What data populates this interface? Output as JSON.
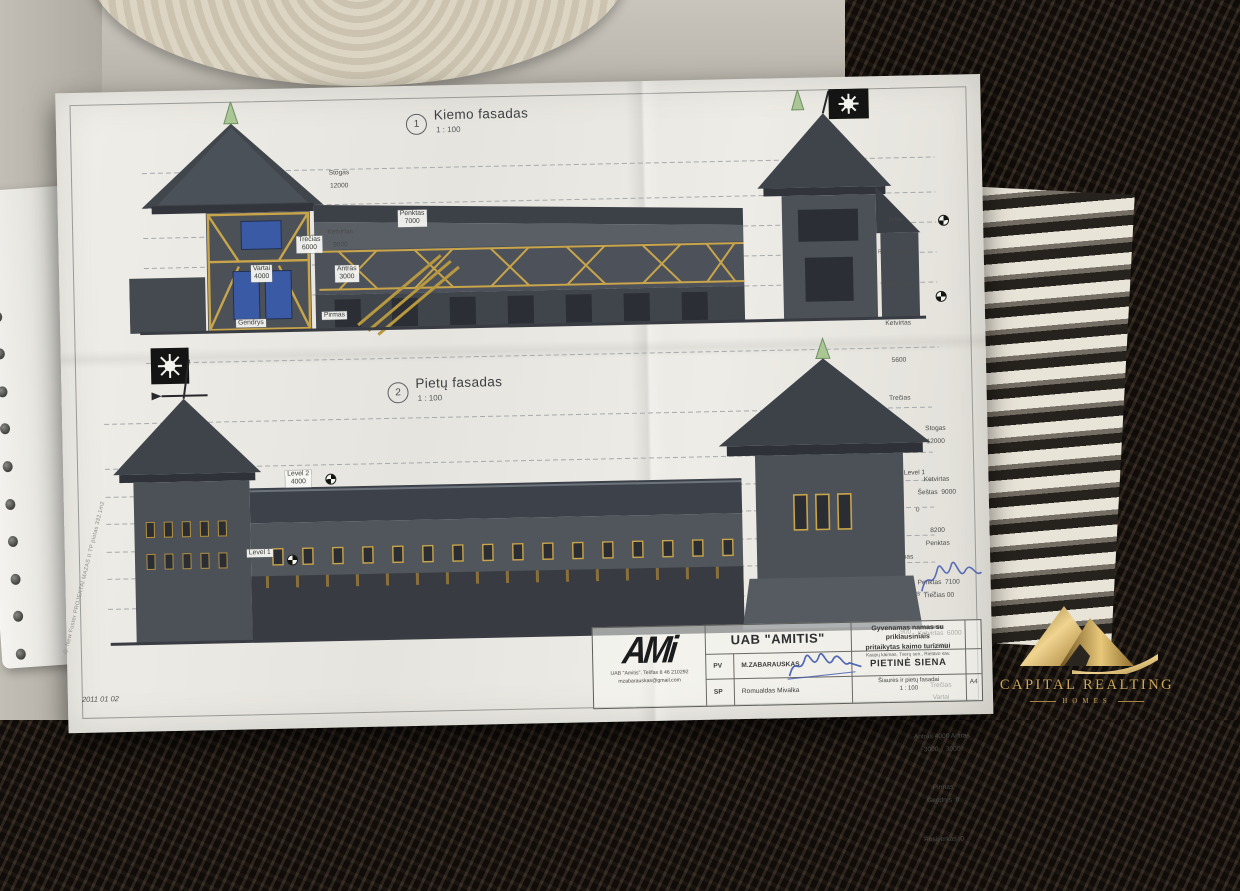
{
  "photo": {
    "date_note": "2011 01 02",
    "margin_note": "G: New Fuster PROJEKTAI MAZAS II TP plotas 332.1m2"
  },
  "drawing1": {
    "number": "1",
    "title": "Kiemo fasadas",
    "scale": "1 : 100",
    "stack_left": [
      "Stogas",
      "12000",
      "Ketvirtas",
      "9000"
    ],
    "label_penktas": {
      "name": "Penktas",
      "value": "7000"
    },
    "label_trecias": {
      "name": "Trečias",
      "value": "6000"
    },
    "label_antras": {
      "name": "Antras",
      "value": "3000"
    },
    "label_vartai": {
      "name": "Vartai",
      "value": "4000"
    },
    "label_pirmas": "Pirmas",
    "label_gendrys": "Gendrys",
    "stack_right": [
      "Šeštas",
      "Penkto stogo alt.",
      "7100  4000",
      "Ketvirtas",
      "5600",
      "Trečias",
      "4500",
      "Antras    Level 1",
      "3000         0",
      "Pirmas",
      "Rosiverkas",
      "-900"
    ]
  },
  "drawing2": {
    "number": "2",
    "title": "Pietų fasadas",
    "scale": "1 : 100",
    "label_level2": {
      "name": "Level 2",
      "value": "4000"
    },
    "label_level1": "Level 1",
    "stack_right": [
      "Stogas",
      "12000",
      "Ketvirtas",
      "Šeštas  9000",
      "8200",
      "Penktas",
      "Penktas  7100",
      "Trečias 00",
      "Ketvirtas  6000",
      "5600",
      "Trečias",
      "Vartai",
      "Antras 4000 Antras",
      "3000    3000",
      "Pirmas",
      "Gendrys  0",
      "Rosiverkas  0"
    ]
  },
  "titleblock": {
    "logo": "AMi",
    "logo_line1": "UAB \"Amitis\". Tel/fax 8 46 210292",
    "logo_line2": "mzabarauskas@gmail.com",
    "company": "UAB \"AMITIS\"",
    "row1_role": "PV",
    "row1_name": "M.ZABARAUSKAS",
    "row2_role": "SP",
    "row2_name": "Romualdas Mivalka",
    "project_line1": "Gyvenamas namas su priklausiniais",
    "project_line2": "pritaikytas kaimo turizmui",
    "project_line3": "Kaupų kaimas, Tverų sen., Rietavo sav.",
    "sheet_title": "PIETINĖ SIENA",
    "view_name": "Šiaurės ir pietų fasadai",
    "view_scale": "1 : 100",
    "format": "A4"
  },
  "watermark": {
    "line1": "CAPITAL REALTING",
    "line2": "HOMES"
  },
  "palette": {
    "gold": "#c9a254",
    "signature_blue": "#3f58ae",
    "timber": "#c8a44a",
    "wall": "#4c5158",
    "roof": "#3c4148",
    "window_blue": "#3b5aa6",
    "tree_green": "#a9c694"
  }
}
